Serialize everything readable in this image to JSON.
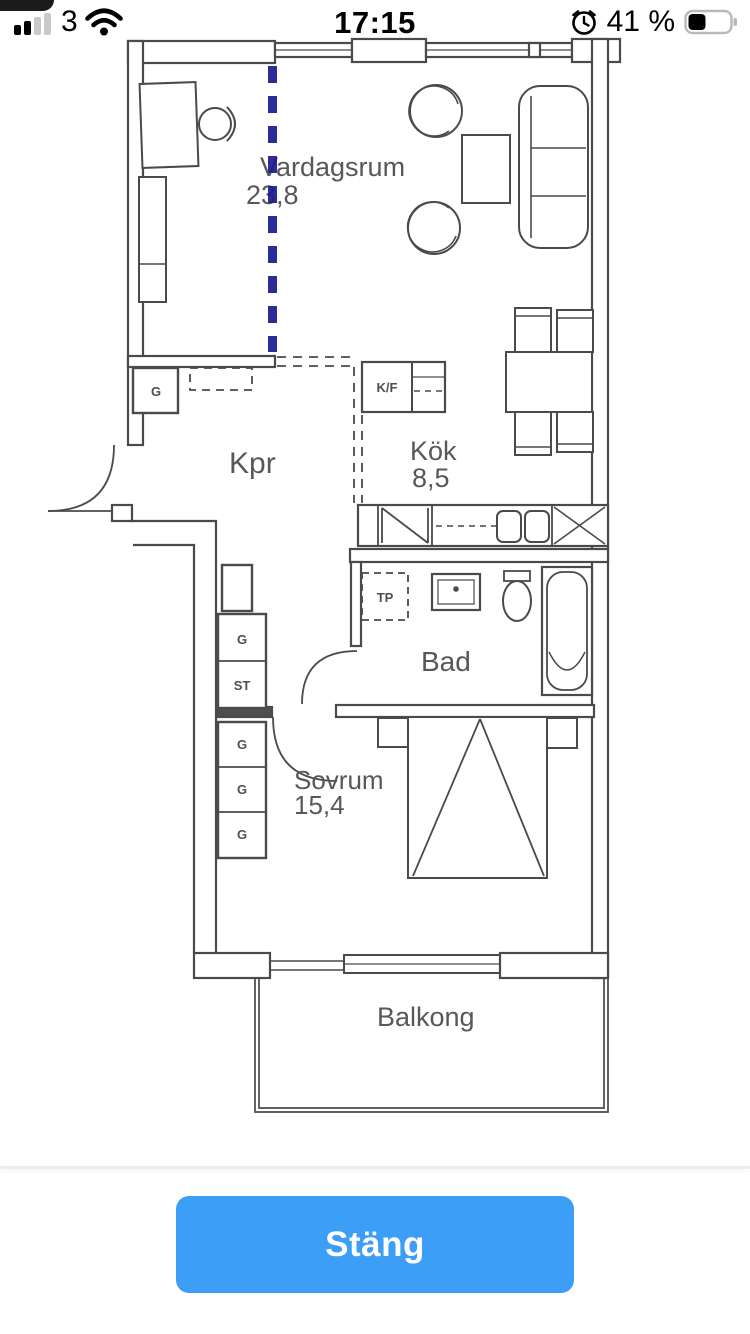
{
  "status_bar": {
    "carrier": "3",
    "time": "17:15",
    "battery_text": "41 %",
    "battery_level": 41,
    "signal_bars_filled": 2,
    "signal_bars_total": 4
  },
  "floor_plan": {
    "rooms": [
      {
        "name": "Vardagsrum",
        "area": "23,8"
      },
      {
        "name": "Kpr",
        "area": ""
      },
      {
        "name": "Kök",
        "area": "8,5"
      },
      {
        "name": "Bad",
        "area": ""
      },
      {
        "name": "Sovrum",
        "area": "15,4"
      },
      {
        "name": "Balkong",
        "area": ""
      }
    ],
    "fixture_labels": {
      "wardrobe": "G",
      "cleaning_closet": "ST",
      "fridge_freezer": "K/F",
      "dryer": "TP"
    },
    "colors": {
      "line": "#4a4a4a",
      "text": "#585858",
      "section_divider_blue": "#1c1d92"
    }
  },
  "footer": {
    "close_button_label": "Stäng",
    "button_color": "#3d9ef8"
  }
}
